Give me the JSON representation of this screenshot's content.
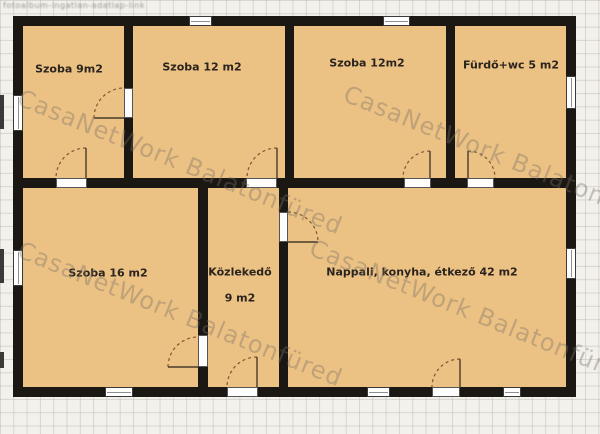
{
  "watermark": {
    "large_text": "CasaNetWork Balatonfüred",
    "small_text": "fotoalbum-ingatlan-adatlap-link"
  },
  "colors": {
    "floor": "#ecc184",
    "wall": "#1b1713",
    "swing": "#7a5733"
  },
  "plan": {
    "interior": [
      23,
      26,
      543,
      361
    ],
    "walls": [
      {
        "id": "outer-top",
        "rect": [
          13,
          16,
          563,
          10
        ]
      },
      {
        "id": "outer-bottom",
        "rect": [
          13,
          387,
          563,
          10
        ]
      },
      {
        "id": "outer-left",
        "rect": [
          13,
          16,
          10,
          381
        ]
      },
      {
        "id": "outer-right",
        "rect": [
          566,
          16,
          10,
          381
        ]
      },
      {
        "id": "partition-room1-room2",
        "rect": [
          124,
          26,
          9,
          152
        ]
      },
      {
        "id": "partition-room2-room3",
        "rect": [
          285,
          26,
          9,
          152
        ]
      },
      {
        "id": "partition-room3-bath",
        "rect": [
          446,
          26,
          9,
          152
        ]
      },
      {
        "id": "middle-horizontal",
        "rect": [
          23,
          178,
          543,
          10
        ]
      },
      {
        "id": "partition-room16-hall",
        "rect": [
          198,
          188,
          10,
          199
        ]
      },
      {
        "id": "partition-hall-living",
        "rect": [
          279,
          188,
          9,
          199
        ]
      }
    ],
    "windows": [
      {
        "id": "top-room2",
        "dir": "h",
        "rect": [
          189,
          16,
          23,
          10
        ]
      },
      {
        "id": "top-room3",
        "dir": "h",
        "rect": [
          383,
          16,
          27,
          10
        ]
      },
      {
        "id": "left-room1",
        "dir": "v",
        "rect": [
          13,
          95,
          10,
          36
        ]
      },
      {
        "id": "left-room16",
        "dir": "v",
        "rect": [
          13,
          250,
          10,
          36
        ]
      },
      {
        "id": "right-bath",
        "dir": "v",
        "rect": [
          566,
          76,
          10,
          33
        ]
      },
      {
        "id": "right-living",
        "dir": "v",
        "rect": [
          566,
          248,
          10,
          31
        ]
      },
      {
        "id": "bottom-room16",
        "dir": "h",
        "rect": [
          105,
          387,
          28,
          10
        ]
      },
      {
        "id": "bottom-living-1",
        "dir": "h",
        "rect": [
          367,
          387,
          23,
          10
        ]
      },
      {
        "id": "bottom-living-2",
        "dir": "h",
        "rect": [
          503,
          387,
          18,
          10
        ]
      }
    ],
    "doors": [
      {
        "id": "room1-room2",
        "gap": [
          124,
          88,
          9,
          30
        ],
        "arc": "M 94 118 A 30 30 0 0 1 124 88",
        "leaf": "M 94 118 L 124 118"
      },
      {
        "id": "room1-room16",
        "gap": [
          56,
          178,
          31,
          10
        ],
        "arc": "M 86 148 A 30 30 0 0 0 56 178",
        "leaf": "M 86 148 L 86 178"
      },
      {
        "id": "room2-hall",
        "gap": [
          246,
          178,
          31,
          10
        ],
        "arc": "M 277 148 A 30 30 0 0 0 247 178",
        "leaf": "M 277 148 L 277 178"
      },
      {
        "id": "room3-living",
        "gap": [
          404,
          178,
          27,
          10
        ],
        "arc": "M 430 151 A 27 27 0 0 0 403 178",
        "leaf": "M 430 151 L 430 178"
      },
      {
        "id": "bath-living",
        "gap": [
          467,
          178,
          27,
          10
        ],
        "arc": "M 468 151 A 27 27 0 0 1 495 178",
        "leaf": "M 468 151 L 468 178"
      },
      {
        "id": "room16-hall",
        "gap": [
          198,
          335,
          10,
          32
        ],
        "arc": "M 168 367 A 30 30 0 0 1 198 337",
        "leaf": "M 168 367 L 198 367"
      },
      {
        "id": "hall-living",
        "gap": [
          279,
          212,
          9,
          30
        ],
        "arc": "M 288 212 A 30 30 0 0 1 318 242",
        "leaf": "M 288 242 L 318 242"
      },
      {
        "id": "entrance",
        "gap": [
          227,
          387,
          31,
          10
        ],
        "arc": "M 257 357 A 30 30 0 0 0 227 387",
        "leaf": "M 257 357 L 257 387"
      },
      {
        "id": "terrace",
        "gap": [
          432,
          387,
          28,
          10
        ],
        "arc": "M 460 359 A 28 28 0 0 0 432 387",
        "leaf": "M 460 359 L 460 387"
      }
    ],
    "rooms": [
      {
        "id": "szoba9",
        "text": "Szoba 9m2",
        "x": 69,
        "y": 69
      },
      {
        "id": "szoba12a",
        "text": "Szoba 12 m2",
        "x": 202,
        "y": 67
      },
      {
        "id": "szoba12b",
        "text": "Szoba 12m2",
        "x": 367,
        "y": 63
      },
      {
        "id": "furdo",
        "text": "Fürdő+wc 5 m2",
        "x": 511,
        "y": 65
      },
      {
        "id": "szoba16",
        "text": "Szoba 16 m2",
        "x": 108,
        "y": 273
      },
      {
        "id": "kozlekedo",
        "text": "Közlekedő",
        "x": 240,
        "y": 272
      },
      {
        "id": "kozlekedo-m2",
        "text": "9 m2",
        "x": 240,
        "y": 298
      },
      {
        "id": "nappali",
        "text": "Nappali, konyha, étkező 42 m2",
        "x": 422,
        "y": 272
      }
    ],
    "edge_marks": [
      [
        0,
        95,
        4,
        34
      ],
      [
        0,
        249,
        4,
        34
      ],
      [
        0,
        352,
        4,
        16
      ]
    ]
  },
  "watermark_positions": [
    {
      "x": 24,
      "y": 84
    },
    {
      "x": 350,
      "y": 80
    },
    {
      "x": 24,
      "y": 236
    },
    {
      "x": 316,
      "y": 234
    }
  ]
}
